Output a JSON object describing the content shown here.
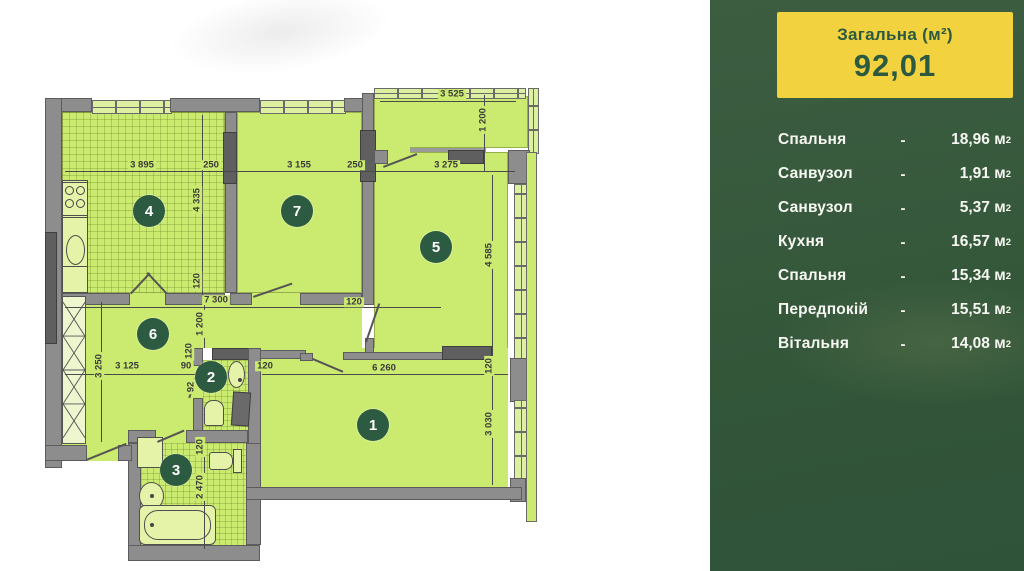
{
  "colors": {
    "sidebar_bg": "#335639",
    "total_box_bg": "#f2d23f",
    "total_text": "#2b5a40",
    "plan_room_fill": "#cbea70",
    "wall_gray": "#8d8d8d",
    "wall_dark": "#5f5f5f",
    "marker_bg": "#2d5b41",
    "marker_text": "#ffffff",
    "dim_text": "#3a3a3a"
  },
  "plan": {
    "markers": [
      "1",
      "2",
      "3",
      "4",
      "5",
      "6",
      "7"
    ],
    "dims": [
      "3 895",
      "250",
      "3 155",
      "250",
      "3 275",
      "3 525",
      "1 200",
      "4 335",
      "120",
      "7 300",
      "1 200",
      "120",
      "3 250",
      "3 125",
      "90",
      "120",
      "6 260",
      "120",
      "3 030",
      "4 585",
      "120",
      "2 470",
      "92",
      "120"
    ]
  },
  "sidebar": {
    "header": {
      "label": "Загальна (м²)",
      "value": "92,01"
    },
    "dash": "-",
    "unit": "м",
    "unit_sup": "2",
    "rows": [
      {
        "name": "Спальня",
        "area": "18,96"
      },
      {
        "name": "Санвузол",
        "area": "1,91"
      },
      {
        "name": "Санвузол",
        "area": "5,37"
      },
      {
        "name": "Кухня",
        "area": "16,57"
      },
      {
        "name": "Спальня",
        "area": "15,34"
      },
      {
        "name": "Передпокій",
        "area": "15,51"
      },
      {
        "name": "Вітальня",
        "area": "14,08"
      }
    ]
  }
}
